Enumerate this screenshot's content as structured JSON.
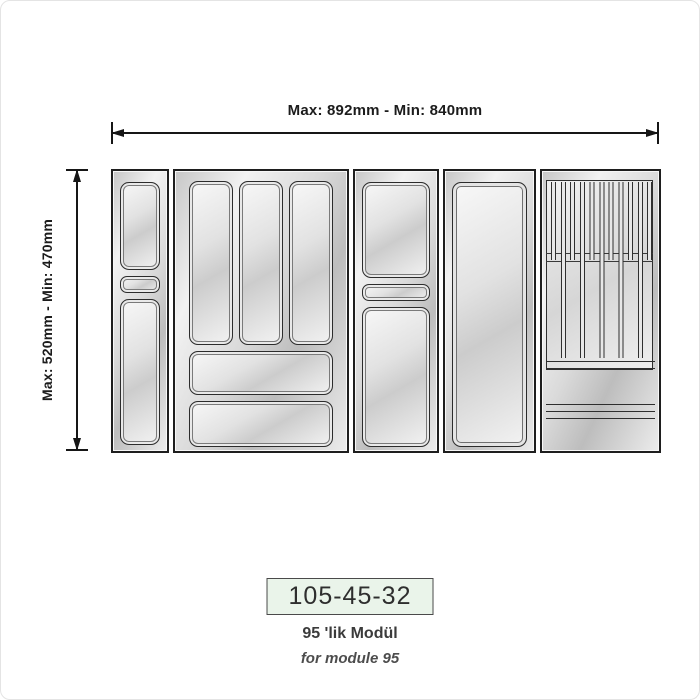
{
  "labels": {
    "width_dimension": "Max: 892mm - Min: 840mm",
    "depth_dimension": "Max: 520mm - Min: 470mm"
  },
  "footer": {
    "product_code": "105-45-32",
    "module_label_tr": "95 'lik Modül",
    "module_label_en": "for module 95"
  },
  "colors": {
    "outline": "#1e1e1e",
    "tray_light": "#f2f2f2",
    "tray_dark": "#bdbdbd",
    "code_box_bg": "#eaf4ea",
    "code_box_border": "#4a4a4a",
    "dimension_text": "#1c1c1c"
  },
  "modules": [
    {
      "name": "narrow two-compartment tray"
    },
    {
      "name": "cutlery tray with three vertical slots and two horizontal compartments"
    },
    {
      "name": "two-compartment tray with divider slot"
    },
    {
      "name": "single open compartment tray"
    },
    {
      "name": "knife block insert"
    }
  ]
}
